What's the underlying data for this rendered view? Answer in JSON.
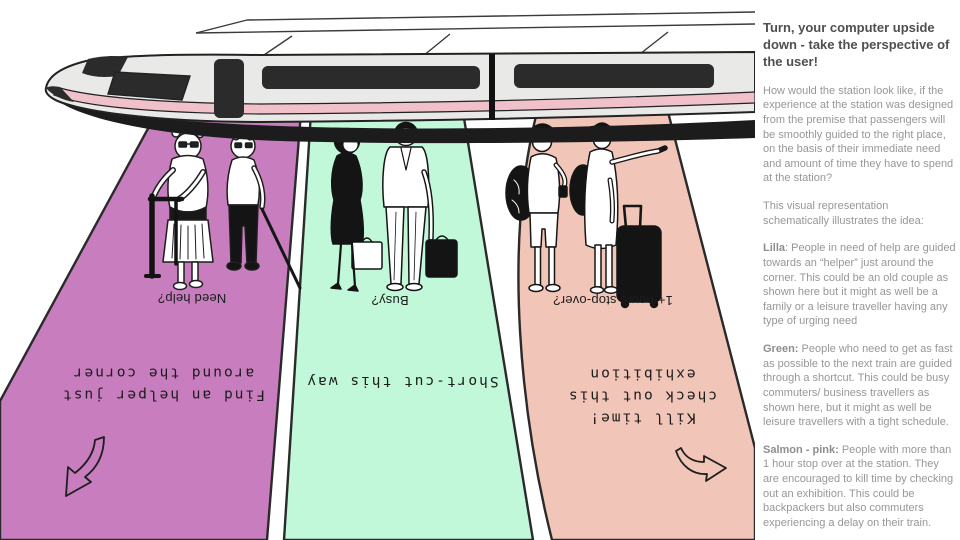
{
  "panel": {
    "title": "Turn, your computer upside down - take the perspective of the user!",
    "intro": "How would the station look like, if the experience at the station was designed from the premise that passengers will be smoothly guided to the right place, on the basis of their immediate need and amount of time they have to spend at the station?",
    "caption": "This visual representation schematically illustrates the idea:",
    "sections": [
      {
        "lead": "Lilla",
        "rest": ": People in need of help are guided towards an “helper” just around the corner. This could be an old couple as shown here but it might as well be a family or a leisure traveller having any type of urging need"
      },
      {
        "lead": "Green:",
        "rest": " People who need to get as fast as possible to the next train are guided through a shortcut. This could be busy commuters/ business travellers as shown here, but it might as well be leisure travellers with a tight schedule."
      },
      {
        "lead": "Salmon - pink:",
        "rest": " People with more than 1 hour stop over at the station. They are encouraged to kill time by checking out an exhibition. This could be backpackers but also commuters experiencing a delay on their train."
      }
    ]
  },
  "lanes": [
    {
      "name": "Lilla",
      "color": "#c77dbe",
      "question": "Need help?",
      "direction": "Find an helper just\naround the corner"
    },
    {
      "name": "Green",
      "color": "#c1f8d9",
      "question": "Busy?",
      "direction": "Short-cut this way"
    },
    {
      "name": "Salmon - pink",
      "color": "#f1c5b7",
      "question": "1+ hours stop-over?",
      "direction": "Kill time!\ncheck out this\nexhibition"
    }
  ],
  "train": {
    "body_color": "#e9e9e8",
    "stripe_color": "#f0c0cb",
    "dark_color": "#2b2b2b",
    "under_color": "#1c1c1c"
  }
}
